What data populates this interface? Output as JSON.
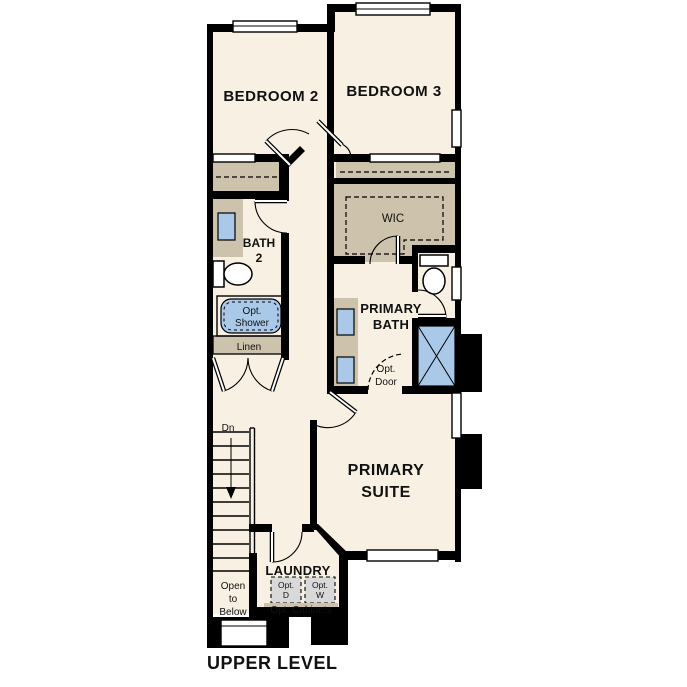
{
  "title": "UPPER LEVEL",
  "plan_name": "upper-level-floor-plan",
  "rooms": {
    "bedroom2": {
      "label": "BEDROOM 2"
    },
    "bedroom3": {
      "label": "BEDROOM 3"
    },
    "bath2": {
      "line1": "BATH",
      "line2": "2"
    },
    "wic": {
      "label": "WIC"
    },
    "primary_bath": {
      "line1": "PRIMARY",
      "line2": "BATH"
    },
    "primary_suite": {
      "line1": "PRIMARY",
      "line2": "SUITE"
    },
    "laundry": {
      "label": "LAUNDRY"
    }
  },
  "annotations": {
    "opt_shower": {
      "line1": "Opt.",
      "line2": "Shower"
    },
    "linen": {
      "label": "Linen"
    },
    "opt_door": {
      "line1": "Opt.",
      "line2": "Door"
    },
    "stairs_down": {
      "label": "Dn"
    },
    "open_to_below": {
      "line1": "Open",
      "line2": "to",
      "line3": "Below"
    },
    "opt_dryer": {
      "line1": "Opt.",
      "line2": "D"
    },
    "opt_washer": {
      "line1": "Opt.",
      "line2": "W"
    },
    "opt_cabinets": {
      "label": "Opt. Cabinets"
    }
  },
  "colors": {
    "background": "#ffffff",
    "floor": "#f7f0e3",
    "wall": "#000000",
    "casework_tan": "#cdc2ab",
    "fixture_blue": "#aac9e9",
    "appliance_gray": "#d9d9d9",
    "text": "#111111"
  }
}
